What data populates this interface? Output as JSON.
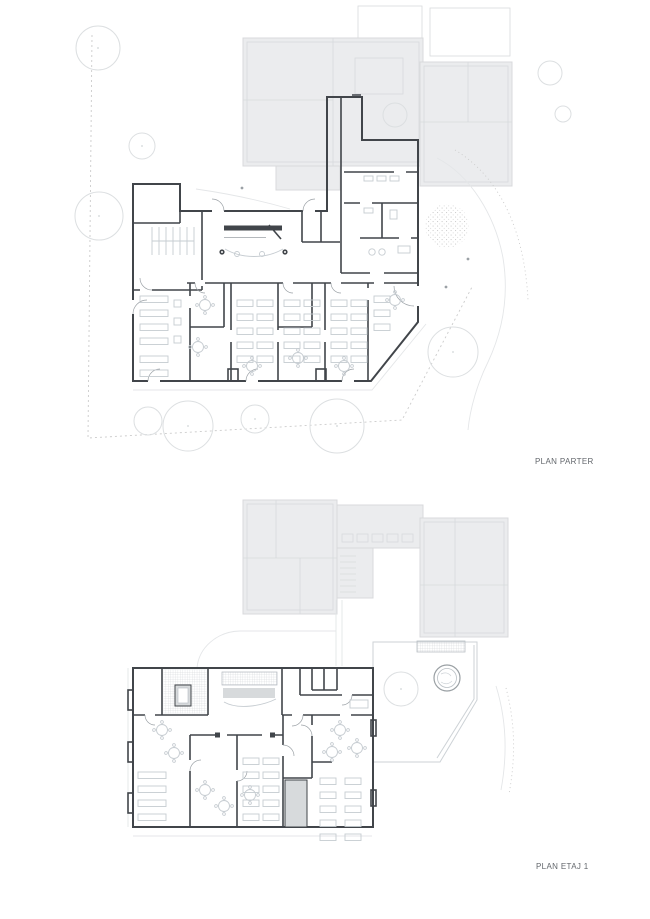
{
  "sheet": {
    "background": "#ffffff",
    "type": "architectural floor plan drawing",
    "plans": [
      {
        "id": "parter",
        "label": "PLAN PARTER"
      },
      {
        "id": "etaj-1",
        "label": "PLAN ETAJ 1"
      }
    ]
  },
  "colors": {
    "page_bg": "#ffffff",
    "wall": "#41454a",
    "existing_fill": "#ebecee",
    "existing_line": "#d8dadc",
    "faint_line": "#e4e6e8",
    "furniture": "#c6ccd1",
    "tree": "#dcdfe1",
    "boundary_dash": "#cbcbcb",
    "door_arc": "#9ba1a6",
    "shaft_fill": "#d7dadc",
    "tile_line": "#e3e7ea",
    "stipple": "#c6c6c6",
    "label_text": "#63676c"
  }
}
